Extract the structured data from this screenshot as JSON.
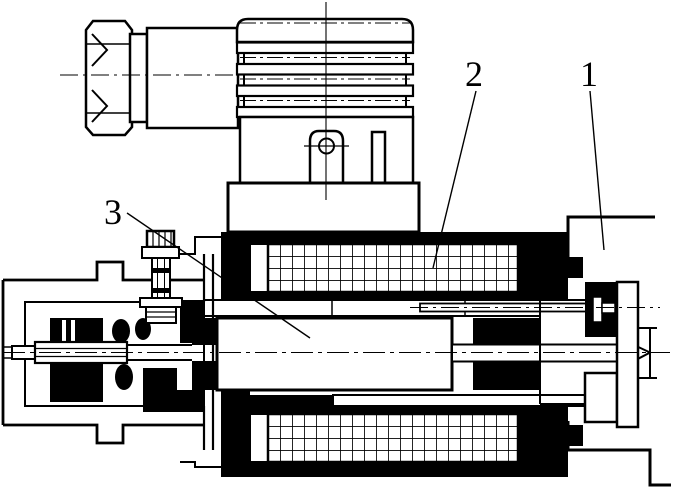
{
  "figure": {
    "description": "black-and-white technical cross-section drawing of a solenoid actuator",
    "paper_color": "#ffffff",
    "ink_color": "#000000",
    "callouts": [
      {
        "label": "1"
      },
      {
        "label": "2"
      },
      {
        "label": "3"
      }
    ]
  }
}
